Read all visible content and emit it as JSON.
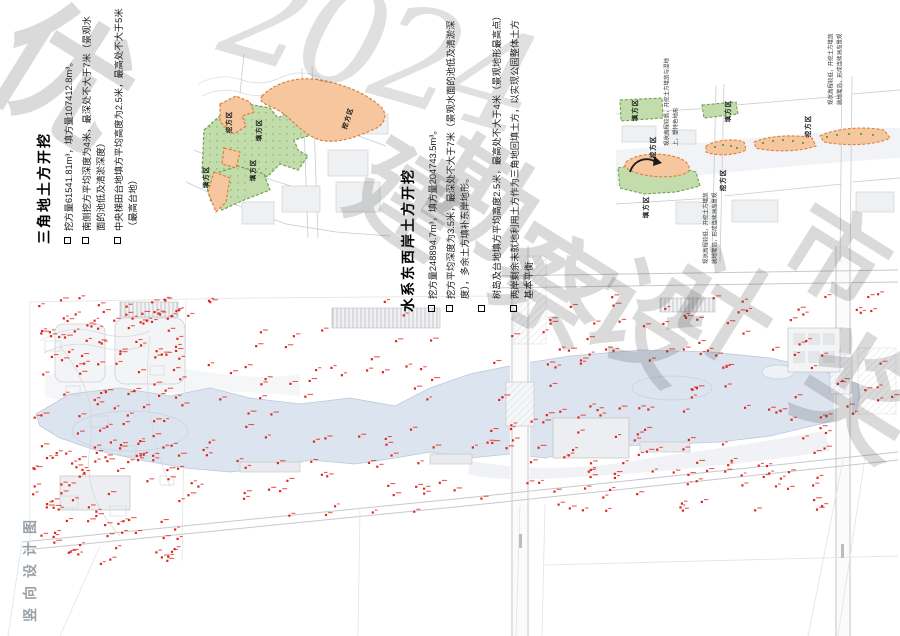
{
  "sheet": {
    "label_vertical": "竖向设计图"
  },
  "sections": {
    "triangle": {
      "title": "三角地土方开挖",
      "bullets": [
        "挖方量61541.81m³，填方量107412.8m³。",
        "南侧挖方平均深度为4米，最深处不大于7米（景观水面的池低及清淤深度）",
        "中央梯田台地填方平均高度为2.5米，最高处不大于5米（最高台地）"
      ]
    },
    "water": {
      "title": "水系东西岸土方开挖",
      "bullets": [
        "挖方量248894.7m³，填方量204743.5m³。",
        "挖方平均深度为3.5米，最深处不大于7米（景观水面的池低及清淤深度），多余土方填补东岸地形。",
        "树岛及台地填方平均高度2.5米，最高处不大于4米（景观地形最高点）",
        "两岸剩余未就地利用土方作为三角地回填土方，以实现公园整体土方基本平衡"
      ]
    }
  },
  "colors": {
    "cut": "#f6c79f",
    "cut_border": "#dd8038",
    "fill": "#c3dcab",
    "fill_border": "#70a150",
    "water": "#dce4ef",
    "marker": "#e0261c"
  },
  "map_triangle": {
    "labels": [
      {
        "t": "挖方区",
        "x": 42,
        "y": 68,
        "r": -90
      },
      {
        "t": "填方区",
        "x": 72,
        "y": 76,
        "r": -90
      },
      {
        "t": "填方区",
        "x": 19,
        "y": 123,
        "r": -90
      },
      {
        "t": "填方区",
        "x": 66,
        "y": 116,
        "r": -90
      },
      {
        "t": "挖方区",
        "x": 161,
        "y": 64,
        "r": -72
      }
    ]
  },
  "map_river": {
    "labels": [
      {
        "t": "填方区",
        "x": 18,
        "y": 60,
        "r": -90
      },
      {
        "t": "挖方区",
        "x": 36,
        "y": 97,
        "r": -90
      },
      {
        "t": "填方区",
        "x": 111,
        "y": 61,
        "r": -90
      },
      {
        "t": "挖方区",
        "x": 106,
        "y": 130,
        "r": -90
      },
      {
        "t": "填方区",
        "x": 29,
        "y": 157,
        "r": -90
      },
      {
        "t": "挖方区",
        "x": 191,
        "y": 76,
        "r": -90
      }
    ],
    "annotations": [
      {
        "text": "现状高程较高，开挖土方堆放与湿地上，塑特色地形",
        "cx": 56,
        "cy": 48,
        "w": 96
      },
      {
        "text": "现状高程较低，开挖土方堆放就地堆岛，形成连续洲岛景观",
        "cx": 95,
        "cy": 178,
        "w": 72
      },
      {
        "text": "现状高程较低，开挖土方堆放就地堆岛，形成连续洲岛景观",
        "cx": 220,
        "cy": 17,
        "w": 76
      }
    ]
  },
  "watermark": {
    "items": [
      {
        "t": "优",
        "x": -5,
        "y": 10,
        "s": 135,
        "r": 32
      },
      {
        "t": "2024",
        "x": 222,
        "y": -20,
        "s": 135,
        "r": 16,
        "f": true
      },
      {
        "t": "建",
        "x": 352,
        "y": 148,
        "s": 108,
        "r": 32
      },
      {
        "t": "勘",
        "x": 425,
        "y": 145,
        "s": 112,
        "r": 32
      },
      {
        "t": "察",
        "x": 495,
        "y": 232,
        "s": 112,
        "r": 32
      },
      {
        "t": "设",
        "x": 590,
        "y": 268,
        "s": 112,
        "r": 32
      },
      {
        "t": "计",
        "x": 665,
        "y": 255,
        "s": 108,
        "r": 32
      },
      {
        "t": "市",
        "x": 785,
        "y": 208,
        "s": 100,
        "r": 32
      },
      {
        "t": "奖",
        "x": 800,
        "y": 338,
        "s": 118,
        "r": 32
      }
    ]
  },
  "main_plan": {
    "seed": 20240707,
    "marker_zones": [
      {
        "x": 32,
        "y": 52,
        "w": 150,
        "h": 265,
        "n": 170
      },
      {
        "x": 185,
        "y": 80,
        "w": 330,
        "h": 190,
        "n": 85
      },
      {
        "x": 540,
        "y": 48,
        "w": 290,
        "h": 70,
        "n": 45
      },
      {
        "x": 525,
        "y": 160,
        "w": 305,
        "h": 105,
        "n": 85
      },
      {
        "x": 833,
        "y": 40,
        "w": 62,
        "h": 130,
        "n": 14
      },
      {
        "x": 545,
        "y": 118,
        "w": 280,
        "h": 45,
        "n": 14
      },
      {
        "x": 30,
        "y": 48,
        "w": 460,
        "h": 30,
        "n": 12
      }
    ]
  }
}
